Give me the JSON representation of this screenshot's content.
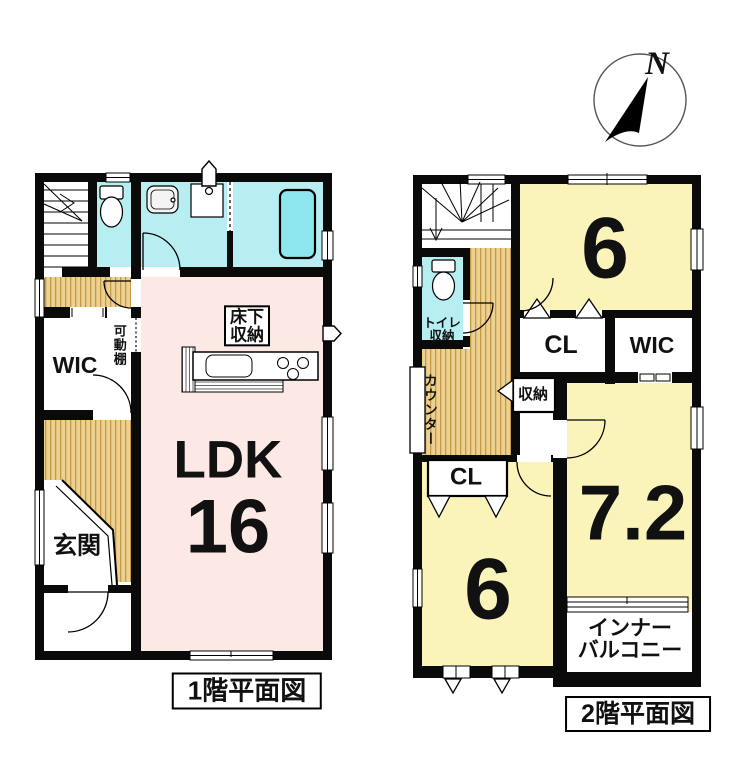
{
  "colors": {
    "wall": "#0a0a0a",
    "wet_room_cyan": "#b7eef2",
    "bathtub_cyan": "#8de5ed",
    "living_pink": "#fce8e5",
    "bedroom_yellow": "#faf4ba",
    "hallway_tan": "#ecd190",
    "hallway_stripe": "#c49a4a"
  },
  "compass": {
    "north_label": "N"
  },
  "floor1": {
    "caption": "1階平面図",
    "labels": {
      "ldk_name": "LDK",
      "ldk_area": "16",
      "entrance": "玄関",
      "wic": "WIC",
      "movable_shelf": "可動棚",
      "underfloor_storage_line1": "床下",
      "underfloor_storage_line2": "収納"
    }
  },
  "floor2": {
    "caption": "2階平面図",
    "labels": {
      "bedroom_north_area": "6",
      "bedroom_south_area": "6",
      "bedroom_east_area": "7.2",
      "closet_north": "CL",
      "closet_south": "CL",
      "wic": "WIC",
      "toilet_line1": "トイレ",
      "toilet_line2": "収納",
      "counter": "カウンター",
      "storage": "収納",
      "inner_balcony_line1": "インナー",
      "inner_balcony_line2": "バルコニー"
    }
  }
}
